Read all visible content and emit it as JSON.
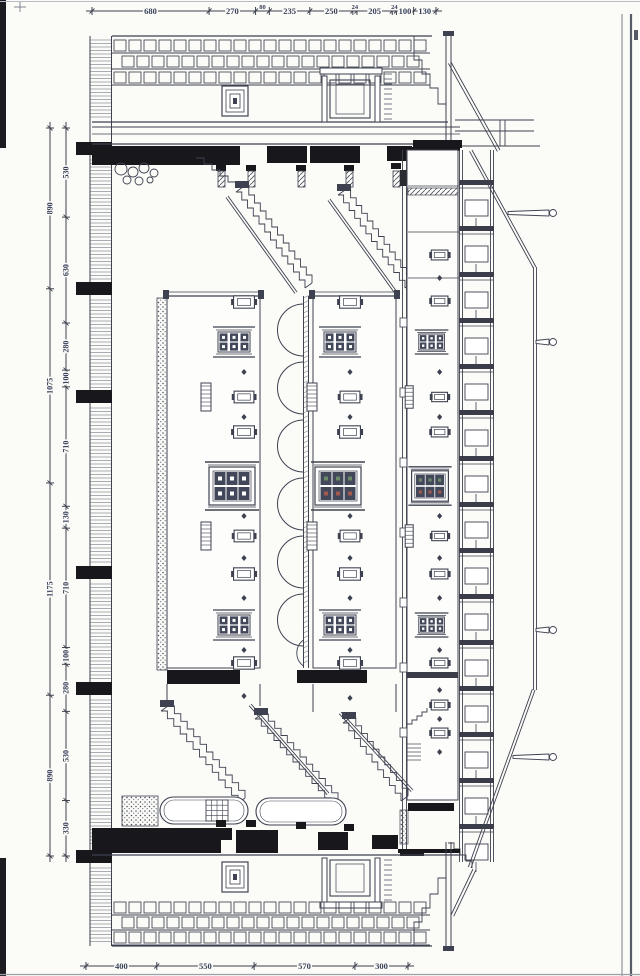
{
  "drawing": {
    "kind": "scanned architectural longitudinal section, rotated 90 degrees",
    "ink_color": "#3e4250",
    "paper_color": "#fbfbf8"
  },
  "dimension_chains": {
    "top": {
      "values": [
        "680",
        "270",
        "80",
        "235",
        "250",
        "24",
        "205",
        "24",
        "100",
        "130"
      ]
    },
    "bottom": {
      "values": [
        "400",
        "550",
        "570",
        "300"
      ]
    },
    "left_outer": {
      "values": [
        "890",
        "1075",
        "1175",
        "890"
      ]
    },
    "left_inner": {
      "values": [
        "530",
        "630",
        "280",
        "100",
        "710",
        "130",
        "710",
        "100",
        "280",
        "530",
        "330"
      ]
    }
  }
}
